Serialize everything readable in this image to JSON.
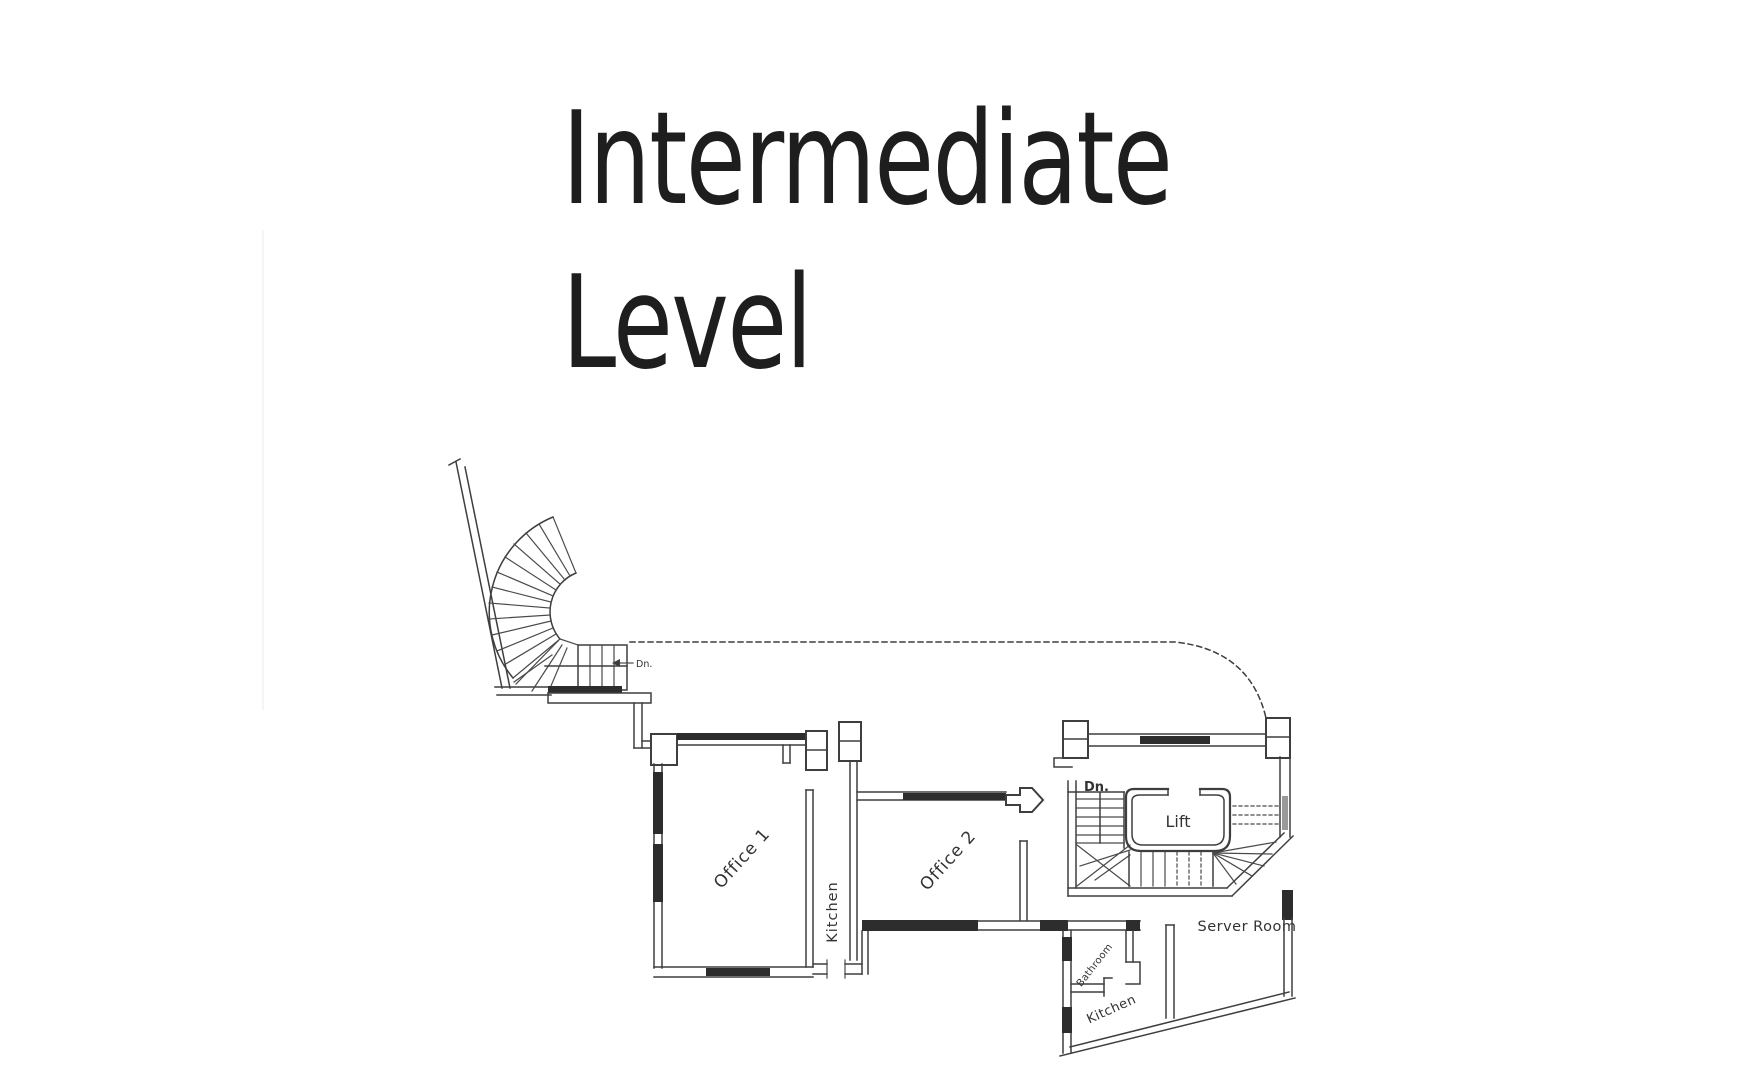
{
  "title": {
    "line1": "Intermediate",
    "line2": "Level"
  },
  "floorplan": {
    "rooms": [
      {
        "id": "office-1",
        "label": "Office 1"
      },
      {
        "id": "kitchen-main",
        "label": "Kitchen"
      },
      {
        "id": "office-2",
        "label": "Office 2"
      },
      {
        "id": "lift",
        "label": "Lift"
      },
      {
        "id": "server-room",
        "label": "Server Room"
      },
      {
        "id": "bathroom",
        "label": "Bathroom"
      },
      {
        "id": "kitchen-rear",
        "label": "Kitchen"
      }
    ],
    "annotations": [
      {
        "id": "stair-down-spiral",
        "label": "Dn."
      },
      {
        "id": "stair-down-lift",
        "label": "Dn."
      }
    ],
    "line_color": "#3e3e3e",
    "text_color": "#333333"
  }
}
